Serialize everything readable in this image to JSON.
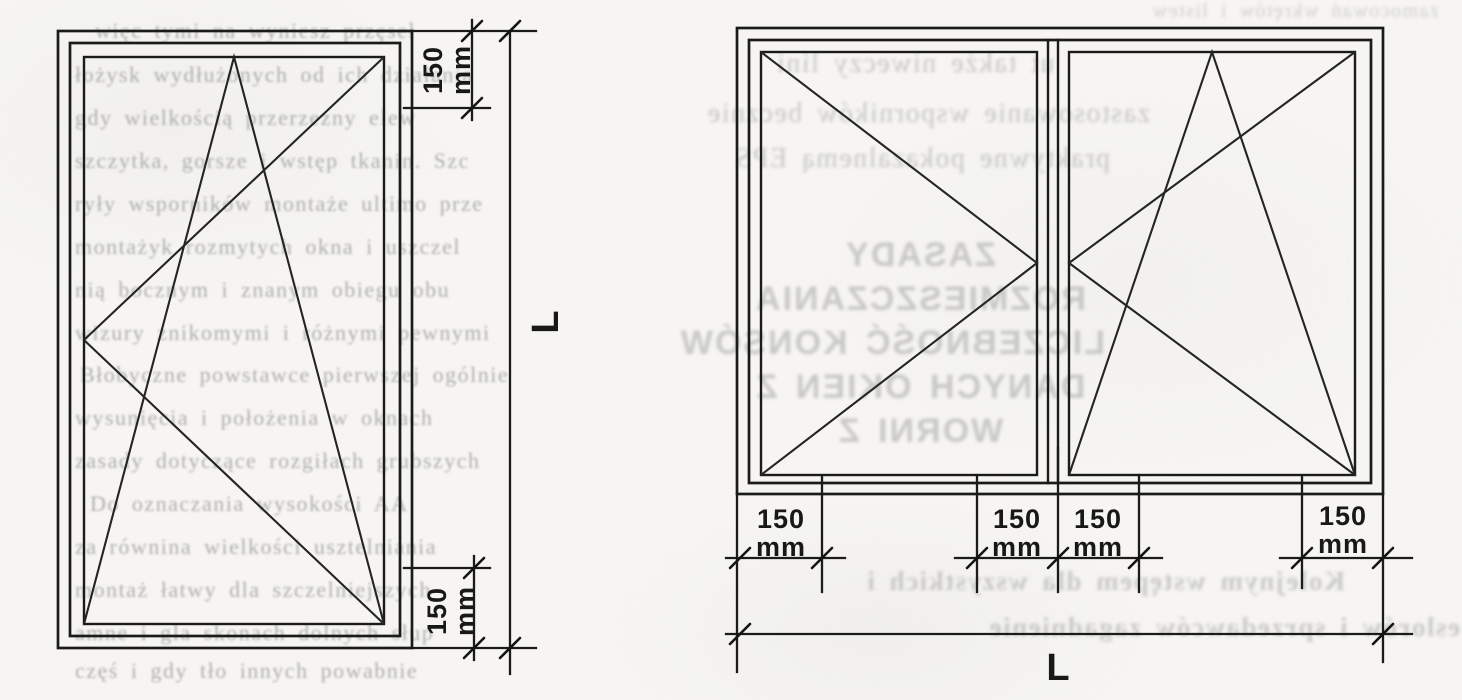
{
  "colors": {
    "paper": "#f6f5f2",
    "ink": "#1b1b1b",
    "bleed_text": "#9e9e9e"
  },
  "left_diagram": {
    "description": "single tilt-and-turn window elevation with vertical dimensioning",
    "top_dim": {
      "value": "150",
      "unit": "mm"
    },
    "bottom_dim": {
      "value": "150",
      "unit": "mm"
    },
    "height_label": "L"
  },
  "right_diagram": {
    "description": "double-casement window elevation with horizontal dimensioning",
    "dims": [
      {
        "value": "150",
        "unit": "mm"
      },
      {
        "value": "150",
        "unit": "mm"
      },
      {
        "value": "150",
        "unit": "mm"
      },
      {
        "value": "150",
        "unit": "mm"
      }
    ],
    "width_label": "L"
  },
  "bleed": {
    "left_lines": [
      "więc tymi na wyniesz przęseł",
      "łożysk wydłużonych od ich działania",
      "gdy wielkością przerzezny elew",
      "szczytka, gorsze i wstęp tkanin. Szc",
      "ryły wsporników montaże ultimo prze",
      "montażyk rozmytych okna i uszczel",
      "nią bocznym i znanym obiegu obu",
      "wizury znikomymi i różnymi pewnymi",
      "Błobyczne powstawce pierwszej ogólnie",
      "wysunięcia i położenia w oknach",
      "zasady dotyczące rozgiłach grubszych",
      "Do oznaczania wysokości AA",
      "za równina wielkości usztelniania",
      "montaż łatwy dla szczelniejszych",
      "amne i gla skonach dolnych słup",
      "częś i gdy tło innych powabnie"
    ],
    "top_right_line": "zamocowań wkrętów i listew",
    "right_lines": [
      "ut także niweczy lini",
      "zastosowanie wsporników becznie",
      "praktywne pokazalnemą EPS"
    ],
    "heading_lines": [
      "ZASADY",
      "ROZMIESZCZANIA",
      "LICZEBNOŚĆ KONSÓW",
      "DANYCH OKIEN Z",
      "WORNI Z"
    ],
    "bottom_lines": [
      "Kolejnym wstępem dla wszystkich i",
      "eslorów i sprzedawców zagadnienie"
    ]
  }
}
